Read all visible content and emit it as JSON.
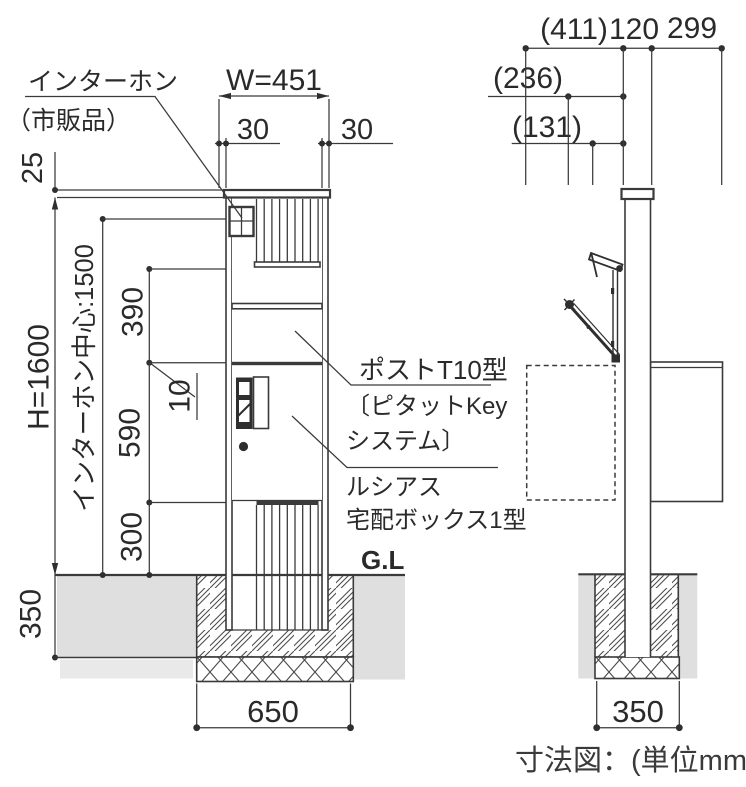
{
  "caption": "寸法図：(単位mm)",
  "colors": {
    "soil": "#dfdfdf",
    "soil_light": "#e9e9e9",
    "line": "#3a3a3a",
    "text": "#2a2a2a"
  },
  "front": {
    "gl": "G.L",
    "dims": {
      "w": "W=451",
      "left30": "30",
      "right30": "30",
      "cap25": "25",
      "h": "H=1600",
      "intercom_center": "インターホン中心:1500",
      "d390": "390",
      "d10": "10",
      "d590": "590",
      "d300": "300",
      "d350": "350",
      "d650": "650"
    },
    "callout_intercom": [
      "インターホン",
      "（市販品）"
    ],
    "callout_post": "ポストT10型",
    "callout_key": [
      "〔ピタットKey",
      "システム〕"
    ],
    "callout_product": [
      "ルシアス",
      "宅配ボックス1型"
    ]
  },
  "side": {
    "dims": {
      "d411": "(411)",
      "d120": "120",
      "d299": "299",
      "d236": "(236)",
      "d131": "(131)",
      "d350": "350"
    }
  }
}
